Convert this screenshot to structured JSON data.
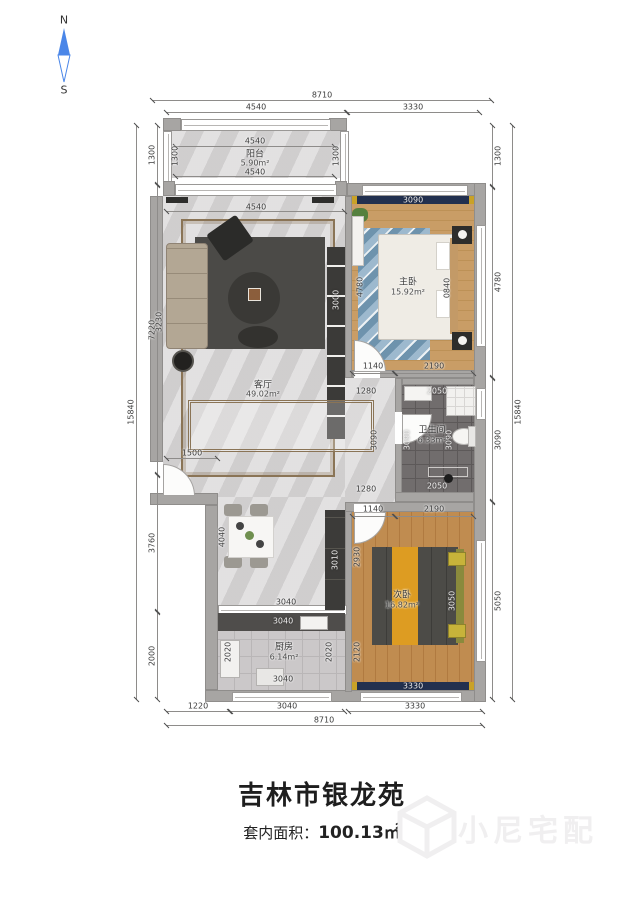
{
  "compass": {
    "north": "N",
    "south": "S"
  },
  "title": {
    "name": "吉林市银龙苑",
    "area_label": "套内面积：",
    "area_value": "100.13㎡"
  },
  "watermark": {
    "brand": "小尼宅配"
  },
  "rooms": {
    "balcony": {
      "name": "阳台",
      "area": "5.90m²"
    },
    "living": {
      "name": "客厅",
      "area": "49.02m²"
    },
    "master": {
      "name": "主卧",
      "area": "15.92m²"
    },
    "bath": {
      "name": "卫生间",
      "area": "6.33m²"
    },
    "second": {
      "name": "次卧",
      "area": "16.82m²"
    },
    "kitchen": {
      "name": "厨房",
      "area": "6.14m²"
    }
  },
  "dims": {
    "top_total": "8710",
    "top_left": "4540",
    "top_right": "3330",
    "balc_top": "4540",
    "balc_bottom": "4540",
    "balc_left": "1300",
    "balc_right": "1300",
    "left_1300": "1300",
    "left_7220": "7220",
    "left_3760": "3760",
    "left_2000": "2000",
    "left_total": "15840",
    "right_1300": "1300",
    "right_4780": "4780",
    "right_3090": "3090",
    "right_5050": "5050",
    "right_total": "15840",
    "bottom_1220": "1220",
    "bottom_3040": "3040",
    "bottom_3330": "3330",
    "bottom_total": "8710",
    "living_top": "4540",
    "living_sofa": "3230",
    "living_tv": "3000",
    "living_1500": "1500",
    "hall_1280a": "1280",
    "hall_3090": "3090",
    "hall_1280b": "1280",
    "master_win": "3090",
    "master_left": "4780",
    "master_side": "0840",
    "master_b1": "1140",
    "master_b2": "2190",
    "bath_top": "2050",
    "bath_left": "3090",
    "bath_right": "3090",
    "bath_bottom": "2050",
    "sec_t1": "1140",
    "sec_t2": "2190",
    "sec_left_a": "2930",
    "sec_left_b": "2120",
    "sec_side": "3050",
    "sec_win": "3330",
    "din_4040": "4040",
    "din_3040": "3040",
    "din_3010": "3010",
    "kit_top": "3040",
    "kit_bottom": "3040",
    "kit_left": "2020",
    "kit_right": "2020"
  }
}
